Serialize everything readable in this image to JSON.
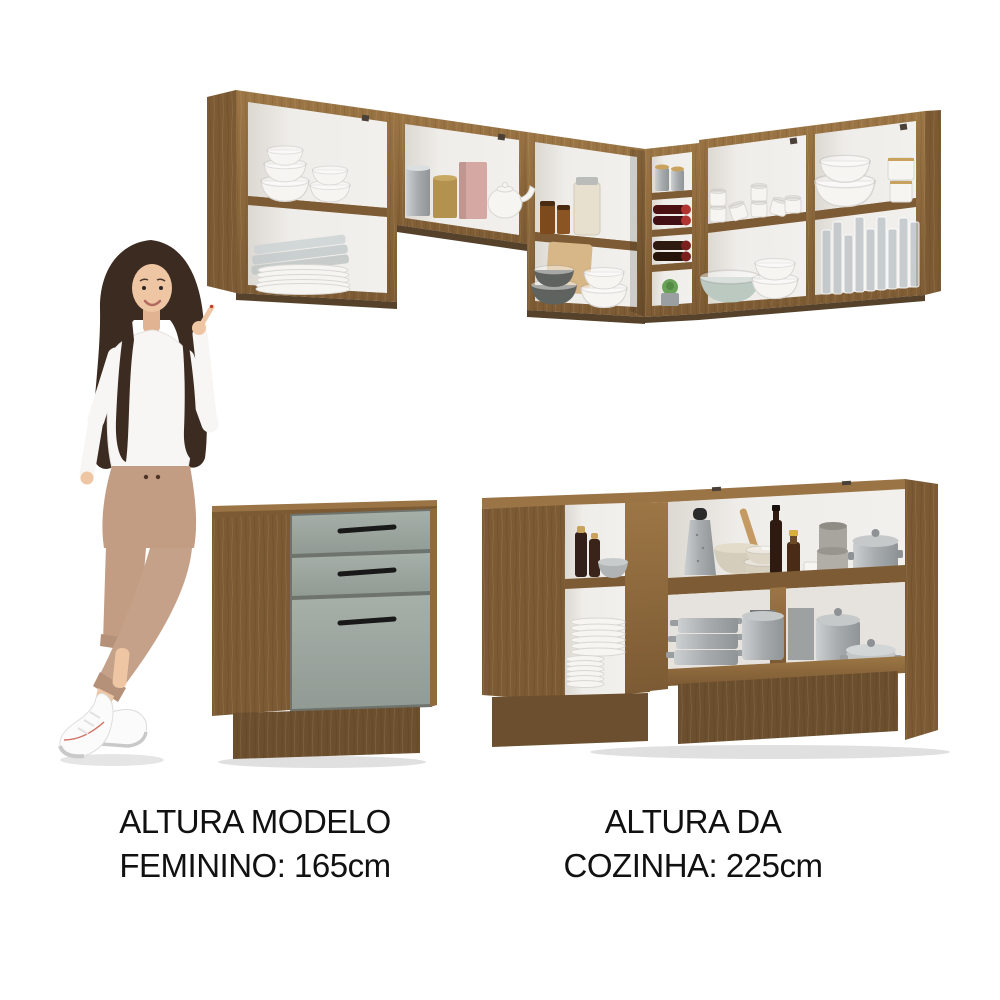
{
  "page": {
    "background": "#ffffff",
    "type": "furniture product photo"
  },
  "captions": {
    "model": {
      "line1": "ALTURA MODELO",
      "line2": "FEMININO: 165cm"
    },
    "kitchen": {
      "line1": "ALTURA DA",
      "line2": "COZINHA: 225cm"
    }
  },
  "scene": {
    "model_woman": {
      "description": "Smiling woman with long dark brown hair, white knit sweater, beige high-waist trousers and white sneakers, legs crossed, pointing up at the wall cabinets",
      "height_reference": "165cm"
    },
    "kitchen_set": {
      "finish": "rustic brown wood, open shelves, white interiors",
      "height_reference": "225cm",
      "upper_cabinets": {
        "shape": "L-shaped wall unit",
        "sections": [
          {
            "name": "left-two-tier-shelf",
            "items": [
              "stacked white bowls",
              "glass baking dishes",
              "stacked white plates"
            ]
          },
          {
            "name": "middle-single-tier-shelf",
            "items": [
              "steel canister",
              "gold tin",
              "rose canister",
              "white teapot"
            ]
          },
          {
            "name": "corner-two-tier-shelf",
            "items": [
              "amber jars",
              "mason jar",
              "cutting board",
              "dark grey bowls",
              "white bowls"
            ]
          },
          {
            "name": "corner-bottle-rack",
            "items": [
              "steel canisters",
              "red-capped bottles",
              "wine bottles",
              "succulent plant"
            ]
          },
          {
            "name": "right-two-tier-shelf-left",
            "items": [
              "white mugs",
              "green scalloped bowl",
              "white bowls"
            ]
          },
          {
            "name": "right-two-tier-shelf-right",
            "items": [
              "white serving bowls",
              "lidded jars",
              "drinking glasses"
            ]
          }
        ]
      },
      "base_cabinets": [
        {
          "name": "three-drawer-base-unit",
          "drawer_count": 3,
          "front_color": "sage grey",
          "handle_style": "black bar"
        },
        {
          "name": "corner-counter-unit",
          "open_niche_items": [
            "oil cruets",
            "metal bowl",
            "stacked white plates"
          ],
          "upper_shelf_items": [
            "box grater",
            "mortar with wooden spoon",
            "beige bowls",
            "dark bottle",
            "bottle with yellow cap",
            "steel canisters",
            "large steel pot"
          ],
          "lower_shelf_items": [
            "stacked aluminium pans",
            "steel pot",
            "lidded pots",
            "low casserole"
          ]
        }
      ]
    }
  },
  "colors": {
    "background": "#ffffff",
    "text": "#111111",
    "wood": "#8f6a3e",
    "wood_light": "#9b7445",
    "wood_side": "#7b5a34",
    "wood_dark": "#7d5b34",
    "wood_under": "#56422a",
    "wood_plinth": "#6b4f2e",
    "drawer_gray": "#9ca69f",
    "handle": "#191919",
    "dish_white": "#f6f5f2",
    "skin": "#eec6a3",
    "hair": "#3c2b21",
    "sweater": "#f7f6f4",
    "pants": "#c29d83",
    "shoe": "#fbfbfb",
    "steel": "#b9bdbe",
    "amber": "#7d4a1e",
    "wine_cap": "#b23430",
    "gold": "#b3924f",
    "pink": "#d6a8a3",
    "plant": "#69a357",
    "bowl_dark": "#5f6360",
    "bowl_green": "#bcc9c0",
    "beige": "#d5cdbc",
    "board": "#d7b688",
    "glassware": "#c7ccce"
  }
}
